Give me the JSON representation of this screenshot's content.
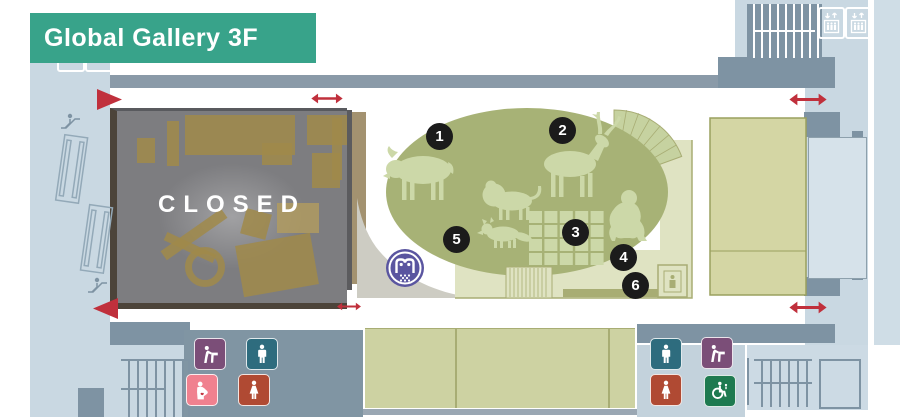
{
  "banner": {
    "title": "Global Gallery 3F"
  },
  "map": {
    "closed_label": "CLOSED",
    "markers": [
      "1",
      "2",
      "3",
      "4",
      "5",
      "6"
    ]
  },
  "icons": {
    "elevator": "elevator-icon",
    "escalator": "escalator-icon",
    "stairs": "stairs-hatching",
    "mens_restroom": "mens-restroom-icon",
    "womens_restroom": "womens-restroom-icon",
    "drinking_fountain": "drinking-fountain-icon",
    "nursing_room": "nursing-room-icon",
    "accessible_restroom": "accessible-restroom-icon",
    "museum_logo": "museum-logo-icon",
    "two_way_passage": "double-arrow-icon",
    "entrance": "triangle-arrow-icon"
  },
  "colors": {
    "banner_teal": "#38a38a",
    "wall_gray": "#7e93a3",
    "band_gray": "#8a9aa8",
    "light_blue": "#c9d8e2",
    "oval_olive": "#a7b276",
    "animal_light": "#ccd8a8",
    "pale_room": "#dfe3c2",
    "khaki_room": "#d4d6a4",
    "closed_gray": "#7d7d80",
    "exhibit_tan": "#a08a4a",
    "arrow_red": "#c0303c",
    "marker_black": "#1b1b1b",
    "icon_purple": "#7b4e78",
    "icon_teal": "#2e6c7e",
    "icon_pink": "#f0818f",
    "icon_red": "#b04a33",
    "icon_green": "#1e7a50",
    "logo_purple": "#5a55a0"
  }
}
